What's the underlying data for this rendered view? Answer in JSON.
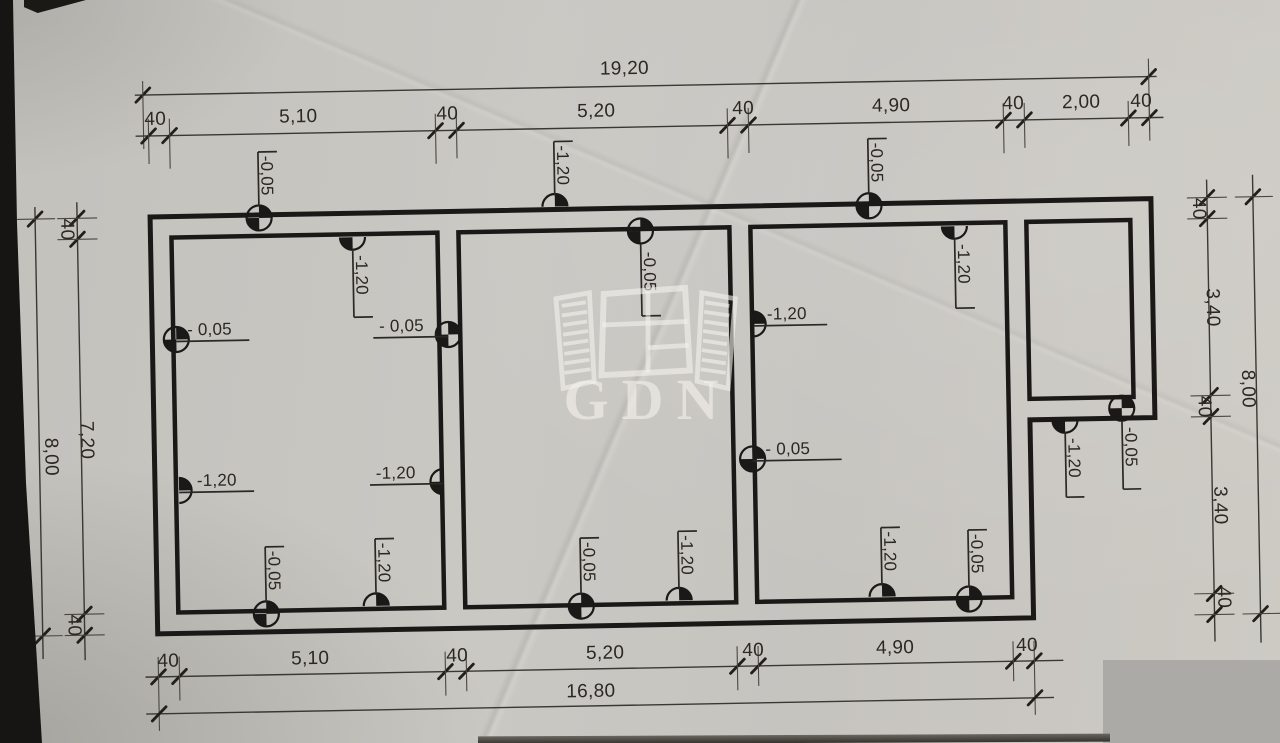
{
  "dimensions": {
    "top": {
      "overall": "19,20",
      "chain": [
        "40",
        "5,10",
        "40",
        "5,20",
        "40",
        "4,90",
        "40",
        "2,00",
        "40"
      ]
    },
    "bottom": {
      "overall": "16,80",
      "chain": [
        "40",
        "5,10",
        "40",
        "5,20",
        "40",
        "4,90",
        "40"
      ]
    },
    "left": {
      "overall": "8,00",
      "chain": [
        "40",
        "7,20",
        "40"
      ]
    },
    "right": {
      "overall": "8,00",
      "chain": [
        "40",
        "3,40",
        "40",
        "3,40",
        "40"
      ]
    }
  },
  "markers": [
    {
      "id": "m1",
      "value": "-0,05"
    },
    {
      "id": "m2",
      "value": "-1,20"
    },
    {
      "id": "m3",
      "value": "-0,05"
    },
    {
      "id": "m4",
      "value": "-1,20"
    },
    {
      "id": "m5",
      "value": "-0,05"
    },
    {
      "id": "m6",
      "value": "-1,20"
    },
    {
      "id": "m7",
      "value": "- 0,05"
    },
    {
      "id": "m8",
      "value": "-1,20"
    },
    {
      "id": "m9",
      "value": "- 0,05"
    },
    {
      "id": "m10",
      "value": "-1,20"
    },
    {
      "id": "m11",
      "value": "-1,20"
    },
    {
      "id": "m12",
      "value": "- 0,05"
    },
    {
      "id": "m13",
      "value": "-1,20"
    },
    {
      "id": "m14",
      "value": "-0,05"
    },
    {
      "id": "m15",
      "value": "-0,05"
    },
    {
      "id": "m16",
      "value": "-1,20"
    },
    {
      "id": "m17",
      "value": "-0,05"
    },
    {
      "id": "m18",
      "value": "-1,20"
    },
    {
      "id": "m19",
      "value": "-1,20"
    },
    {
      "id": "m20",
      "value": "-0,05"
    }
  ],
  "watermark": {
    "brand": "GDN",
    "logo": "open-window-icon"
  },
  "colors": {
    "paper": "#c9c7c2",
    "ink": "#1b1917",
    "watermark": "rgba(243,241,235,0.62)",
    "patch": "#acaaa7"
  }
}
